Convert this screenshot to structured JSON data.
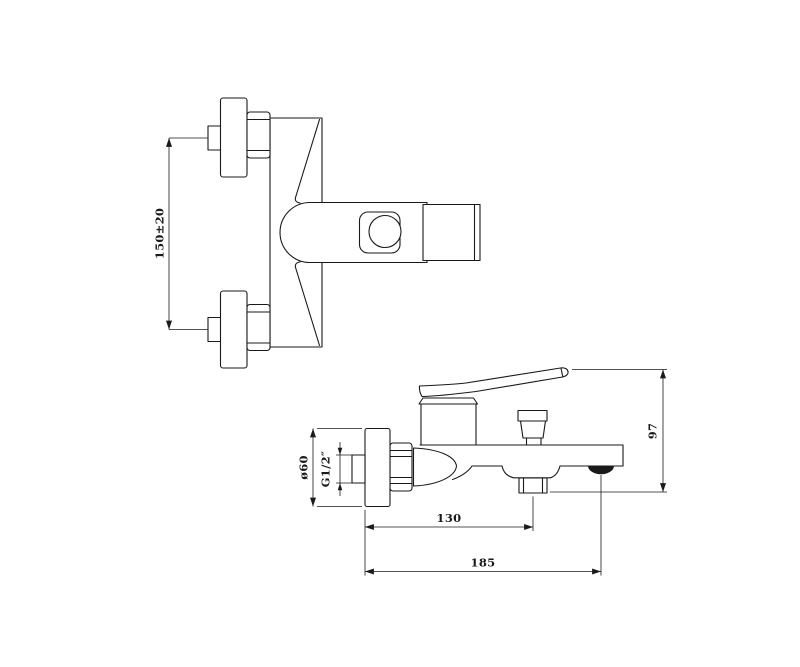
{
  "colors": {
    "background": "#ffffff",
    "line": "#1a1a1a"
  },
  "drawing": {
    "subject": "wall-mounted bath shower mixer tap, two-view installation drawing"
  },
  "front_view": {
    "dimensions": {
      "inlet_spacing": {
        "label": "150±20"
      }
    }
  },
  "side_view": {
    "dimensions": {
      "escutcheon_diameter": {
        "label": "ø60"
      },
      "inlet_thread": {
        "label": "G1/2″"
      },
      "wall_to_shower_outlet": {
        "label": "130"
      },
      "wall_to_spout_end": {
        "label": "185"
      },
      "body_height": {
        "label": "97"
      }
    }
  }
}
